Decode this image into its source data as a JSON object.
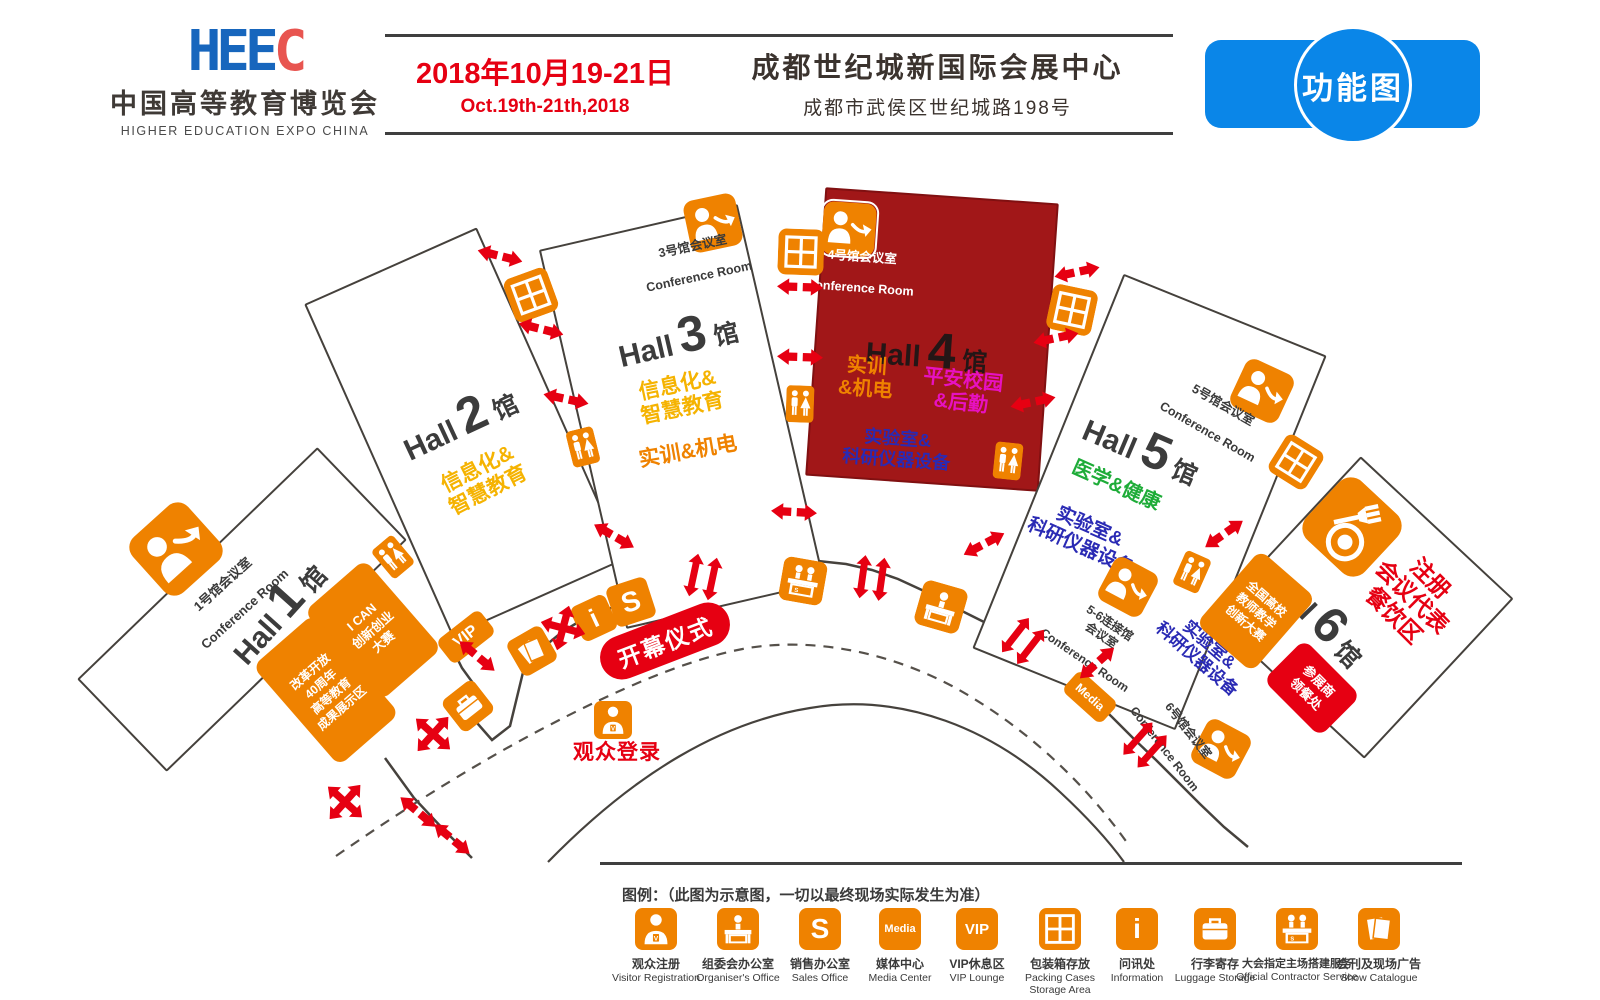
{
  "header": {
    "logo": {
      "acronym_blue": "HEE",
      "acronym_red": "C",
      "title_cn": "中国高等教育博览会",
      "title_en": "HIGHER EDUCATION EXPO CHINA"
    },
    "date_cn": "2018年10月19-21日",
    "date_en": "Oct.19th-21th,2018",
    "venue_cn": "成都世纪城新国际会展中心",
    "venue_address": "成都市武侯区世纪城路198号",
    "badge": "功能图"
  },
  "map": {
    "halls": [
      {
        "name": "Hall",
        "num": "1",
        "unit": "馆"
      },
      {
        "name": "Hall",
        "num": "2",
        "unit": "馆"
      },
      {
        "name": "Hall",
        "num": "3",
        "unit": "馆"
      },
      {
        "name": "Hall",
        "num": "4",
        "unit": "馆"
      },
      {
        "name": "Hall",
        "num": "5",
        "unit": "馆"
      },
      {
        "name": "Hall",
        "num": "6",
        "unit": "馆"
      }
    ],
    "conference_rooms": {
      "c1": {
        "cn": "1号馆会议室",
        "en": "Conference Room"
      },
      "c3": {
        "cn": "3号馆会议室",
        "en": "Conference Room"
      },
      "c4": {
        "cn": "4号馆会议室",
        "en": "Conference Room"
      },
      "c5": {
        "cn": "5号馆会议室",
        "en": "Conference Room"
      },
      "c56": {
        "cn": "5-6连接馆\n会议室",
        "en": "Conference Room"
      },
      "c6": {
        "cn": "6号馆会议室",
        "en": "Conference Room"
      }
    },
    "zones": {
      "hall1_reform": "改革开放\n40周年\n高等教育\n成果展示区",
      "hall1_ican": "I CAN\n创新创业\n大赛",
      "hall2_info": "信息化&\n智慧教育",
      "hall3_info": "信息化&\n智慧教育",
      "hall3_training": "实训&机电",
      "hall4_training": "实训\n&机电",
      "hall4_campus": "平安校园\n&后勤",
      "hall4_lab": "实验室&\n科研仪器设备",
      "hall5_medical": "医学&健康",
      "hall5_lab": "实验室&\n科研仪器设备",
      "hall6_lab": "实验室&\n科研仪器设备",
      "hall6_registration": "注册\n会议代表\n餐饮区",
      "hall6_meal": "参展商\n领餐处",
      "hall6_contest": "全国高校\n教师教学\n创新大赛"
    },
    "labels": {
      "opening_ceremony": "开幕仪式",
      "visitor_login": "观众登录",
      "vip": "VIP",
      "media": "Media",
      "sales": "S",
      "info": "i"
    }
  },
  "legend": {
    "title": "图例：（此图为示意图，一切以最终现场实际发生为准）",
    "items": [
      {
        "icon": "visitor-registration-icon",
        "cn": "观众注册",
        "en": "Visitor Registration"
      },
      {
        "icon": "organiser-office-icon",
        "cn": "组委会办公室",
        "en": "Organiser's Office"
      },
      {
        "icon": "sales-office-icon",
        "cn": "销售办公室",
        "en": "Sales Office"
      },
      {
        "icon": "media-center-icon",
        "cn": "媒体中心",
        "en": "Media Center"
      },
      {
        "icon": "vip-lounge-icon",
        "cn": "VIP休息区",
        "en": "VIP Lounge"
      },
      {
        "icon": "packing-cases-icon",
        "cn": "包装箱存放",
        "en": "Packing Cases\nStorage Area"
      },
      {
        "icon": "information-icon",
        "cn": "问讯处",
        "en": "Information"
      },
      {
        "icon": "luggage-storage-icon",
        "cn": "行李寄存",
        "en": "Luggage Storage"
      },
      {
        "icon": "official-contractor-icon",
        "cn": "大会指定主场搭建服务",
        "en": "Official Contractor Service"
      },
      {
        "icon": "show-catalogue-icon",
        "cn": "会刊及现场广告",
        "en": "Show Catalogue"
      }
    ]
  },
  "colors": {
    "orange": "#ef8200",
    "red": "#e60012",
    "hall4_red": "#a11718",
    "yellow": "#f5b301",
    "green": "#1eac38",
    "blue": "#2a2ab4",
    "magenta": "#e711c1",
    "badge_blue": "#0a86e8"
  }
}
